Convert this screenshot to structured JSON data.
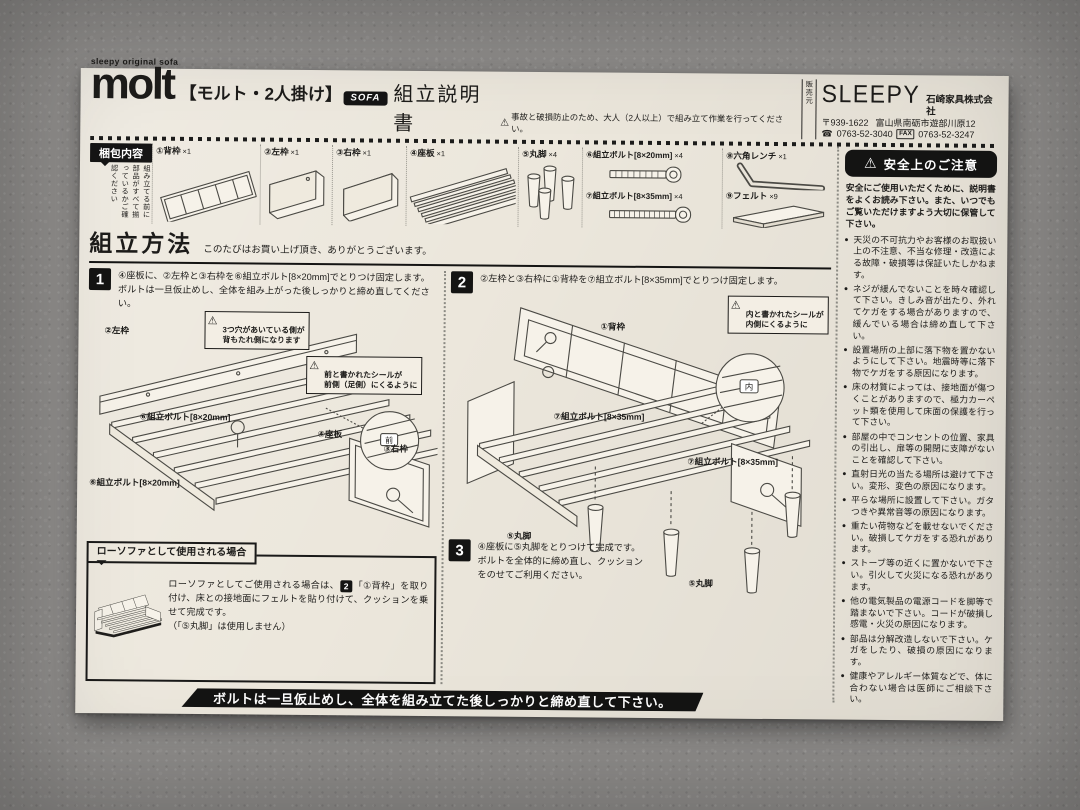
{
  "header": {
    "brand_small": "sleepy original sofa",
    "logo": "molt",
    "product_name": "【モルト・2人掛け】",
    "badge": "SOFA",
    "doc_title": "組立説明書",
    "caution": "事故と破損防止のため、大人（2人以上）で組み立て作業を行ってください。",
    "seller_label": "販売元",
    "company_logo": "SLEEPY",
    "company_name": "石崎家具株式会社",
    "postal": "〒939-1622",
    "address": "富山県南砺市遊部川原12",
    "tel": "0763-52-3040",
    "fax": "0763-52-3247"
  },
  "contents": {
    "label": "梱包内容",
    "note": "組み立てる前に部品がすべて揃っているかご確認ください",
    "items": [
      {
        "name": "①背枠",
        "qty": "×1"
      },
      {
        "name": "②左枠",
        "qty": "×1"
      },
      {
        "name": "③右枠",
        "qty": "×1"
      },
      {
        "name": "④座板",
        "qty": "×1"
      },
      {
        "name": "⑤丸脚",
        "qty": "×4"
      },
      {
        "name": "⑥組立ボルト[8×20mm]",
        "qty": "×4"
      },
      {
        "name": "⑦組立ボルト[8×35mm]",
        "qty": "×4"
      },
      {
        "name": "⑧六角レンチ",
        "qty": "×1"
      },
      {
        "name": "⑨フェルト",
        "qty": "×9"
      }
    ]
  },
  "assembly": {
    "title": "組立方法",
    "subtitle": "このたびはお買い上げ頂き、ありがとうございます。",
    "step1": {
      "num": "1",
      "text": "④座板に、②左枠と③右枠を⑥組立ボルト[8×20mm]でとりつけ固定します。\nボルトは一旦仮止めし、全体を組み上がった後しっかりと締め直してください。",
      "label_left_frame": "②左枠",
      "warn_holes": "3つ穴があいている側が\n背もたれ側になります",
      "warn_sticker": "前と書かれたシールが\n前側（足側）にくるように",
      "sticker": "前",
      "label_bolt_a": "⑥組立ボルト[8×20mm]",
      "label_bolt_b": "⑥組立ボルト[8×20mm]",
      "label_seat": "④座板",
      "label_right_frame": "③右枠"
    },
    "step2": {
      "num": "2",
      "text": "②左枠と③右枠に①背枠を⑦組立ボルト[8×35mm]でとりつけ固定します。",
      "label_back_frame": "①背枠",
      "warn_sticker": "内と書かれたシールが\n内側にくるように",
      "sticker": "内",
      "label_bolt_a": "⑦組立ボルト[8×35mm]",
      "label_bolt_b": "⑦組立ボルト[8×35mm]",
      "label_leg_a": "⑤丸脚",
      "label_leg_b": "⑤丸脚"
    },
    "step3": {
      "num": "3",
      "text": "④座板に⑤丸脚をとりつけて完成です。\nボルトを全体的に締め直し、クッション\nをのせてご利用ください。"
    }
  },
  "low_sofa": {
    "title": "ローソファとして使用される場合",
    "part1": "ローソファとしてご使用される場合は、",
    "step_ref": "2",
    "part2": "「①背枠」を取り付け、床との接地面にフェルトを貼り付けて、クッションを乗せて完成です。",
    "note": "（「⑤丸脚」は使用しません）"
  },
  "footer_banner": "ボルトは一旦仮止めし、全体を組み立てた後しっかりと締め直して下さい。",
  "safety": {
    "title": "安全上のご注意",
    "intro": "安全にご使用いただくために、説明書をよくお読み下さい。また、いつでもご覧いただけますよう大切に保管して下さい。",
    "bullets": [
      "天災の不可抗力やお客様のお取扱い上の不注意、不当な修理・改造による故障・破損等は保証いたしかねます。",
      "ネジが緩んでないことを時々確認して下さい。きしみ音が出たり、外れてケガをする場合がありますので、緩んでいる場合は締め直して下さい。",
      "設置場所の上部に落下物を置かないようにして下さい。地震時等に落下物でケガをする原因になります。",
      "床の材質によっては、接地面が傷つくことがありますので、極力カーペット類を使用して床面の保護を行って下さい。",
      "部屋の中でコンセントの位置、家具の引出し、扉等の開閉に支障がないことを確認して下さい。",
      "直射日光の当たる場所は避けて下さい。変形、変色の原因になります。",
      "平らな場所に設置して下さい。ガタつきや異常音等の原因になります。",
      "重たい荷物などを載せないでください。破損してケガをする恐れがあります。",
      "ストーブ等の近くに置かないで下さい。引火して火災になる恐れがあります。",
      "他の電気製品の電源コードを脚等で踏まないで下さい。コードが破損し感電・火災の原因になります。",
      "部品は分解改造しないで下さい。ケガをしたり、破損の原因になります。",
      "健康やアレルギー体質などで、体に合わない場合は医師にご相談下さい。"
    ]
  }
}
